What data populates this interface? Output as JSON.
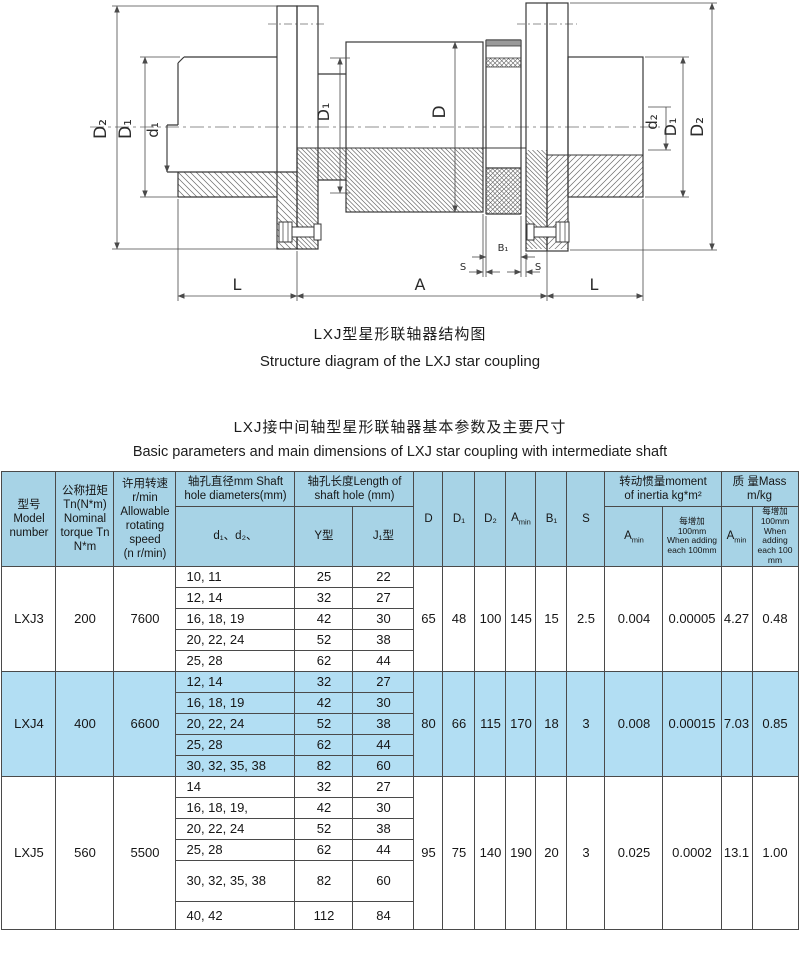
{
  "drawing": {
    "caption_zh": "LXJ型星形联轴器结构图",
    "caption_en": "Structure diagram of the LXJ star coupling",
    "dims": {
      "d2_left": "D₂",
      "d1_left": "D₁",
      "bore_left": "d₁",
      "d1_mid": "D₁",
      "d_mid": "D",
      "bore_right": "d₂",
      "d1_right": "D₁",
      "d2_right": "D₂",
      "len_left": "L",
      "len_mid": "A",
      "len_right": "L",
      "b1": "B₁",
      "s_left": "S",
      "s_right": "S"
    }
  },
  "section": {
    "title_zh": "LXJ接中间轴型星形联轴器基本参数及主要尺寸",
    "title_en": "Basic parameters and main dimensions of LXJ star coupling with intermediate shaft"
  },
  "table": {
    "colors": {
      "header_bg": "#a7d3e6",
      "highlight_bg": "#b2def3",
      "border": "#4a4a4a"
    },
    "header": {
      "model": "型号\nModel\nnumber",
      "torque": "公称扭矩\nTn(N*m)\nNominal\ntorque Tn\nN*m",
      "speed": "许用转速\nr/min\nAllowable\nrotating\nspeed\n(n r/min)",
      "dia_group": "轴孔直径mm Shaft\nhole diameters(mm)",
      "dia_sub": "d₁、d₂、",
      "len_group": "轴孔长度Length of\nshaft hole (mm)",
      "len_y": "Y型",
      "len_j": "J₁型",
      "d": "D",
      "d1": "D₁",
      "d2": "D₂",
      "amin_main": "A",
      "amin_sub": "min",
      "b1": "B₁",
      "s": "S",
      "inertia_group": "转动惯量moment\nof inertia kg*m²",
      "inertia_add": "每增加100mm\nWhen adding\neach 100mm",
      "mass_group": "质 量Mass\nm/kg",
      "mass_add": "每增加100mm\nWhen adding\neach 100 mm"
    },
    "rows": [
      {
        "model": "LXJ3",
        "torque": "200",
        "speed": "7600",
        "bores": [
          {
            "d": "10, 11",
            "y": "25",
            "j": "22"
          },
          {
            "d": "12, 14",
            "y": "32",
            "j": "27"
          },
          {
            "d": "16, 18, 19",
            "y": "42",
            "j": "30"
          },
          {
            "d": "20, 22, 24",
            "y": "52",
            "j": "38"
          },
          {
            "d": "25, 28",
            "y": "62",
            "j": "44"
          }
        ],
        "D": "65",
        "D1": "48",
        "D2": "100",
        "Amin": "145",
        "B1": "15",
        "S": "2.5",
        "inertia_amin": "0.004",
        "inertia_add": "0.00005",
        "mass_amin": "4.27",
        "mass_add": "0.48"
      },
      {
        "model": "LXJ4",
        "torque": "400",
        "speed": "6600",
        "bores": [
          {
            "d": "12, 14",
            "y": "32",
            "j": "27"
          },
          {
            "d": "16, 18, 19",
            "y": "42",
            "j": "30"
          },
          {
            "d": "20, 22, 24",
            "y": "52",
            "j": "38"
          },
          {
            "d": "25, 28",
            "y": "62",
            "j": "44"
          },
          {
            "d": "30, 32, 35, 38",
            "y": "82",
            "j": "60"
          }
        ],
        "D": "80",
        "D1": "66",
        "D2": "115",
        "Amin": "170",
        "B1": "18",
        "S": "3",
        "inertia_amin": "0.008",
        "inertia_add": "0.00015",
        "mass_amin": "7.03",
        "mass_add": "0.85"
      },
      {
        "model": "LXJ5",
        "torque": "560",
        "speed": "5500",
        "bores": [
          {
            "d": "14",
            "y": "32",
            "j": "27"
          },
          {
            "d": "16, 18, 19,",
            "y": "42",
            "j": "30"
          },
          {
            "d": "20, 22, 24",
            "y": "52",
            "j": "38"
          },
          {
            "d": "25, 28",
            "y": "62",
            "j": "44"
          },
          {
            "d": "30, 32, 35, 38",
            "y": "82",
            "j": "60"
          },
          {
            "d": "40, 42",
            "y": "112",
            "j": "84"
          }
        ],
        "D": "95",
        "D1": "75",
        "D2": "140",
        "Amin": "190",
        "B1": "20",
        "S": "3",
        "inertia_amin": "0.025",
        "inertia_add": "0.0002",
        "mass_amin": "13.1",
        "mass_add": "1.00"
      }
    ]
  }
}
